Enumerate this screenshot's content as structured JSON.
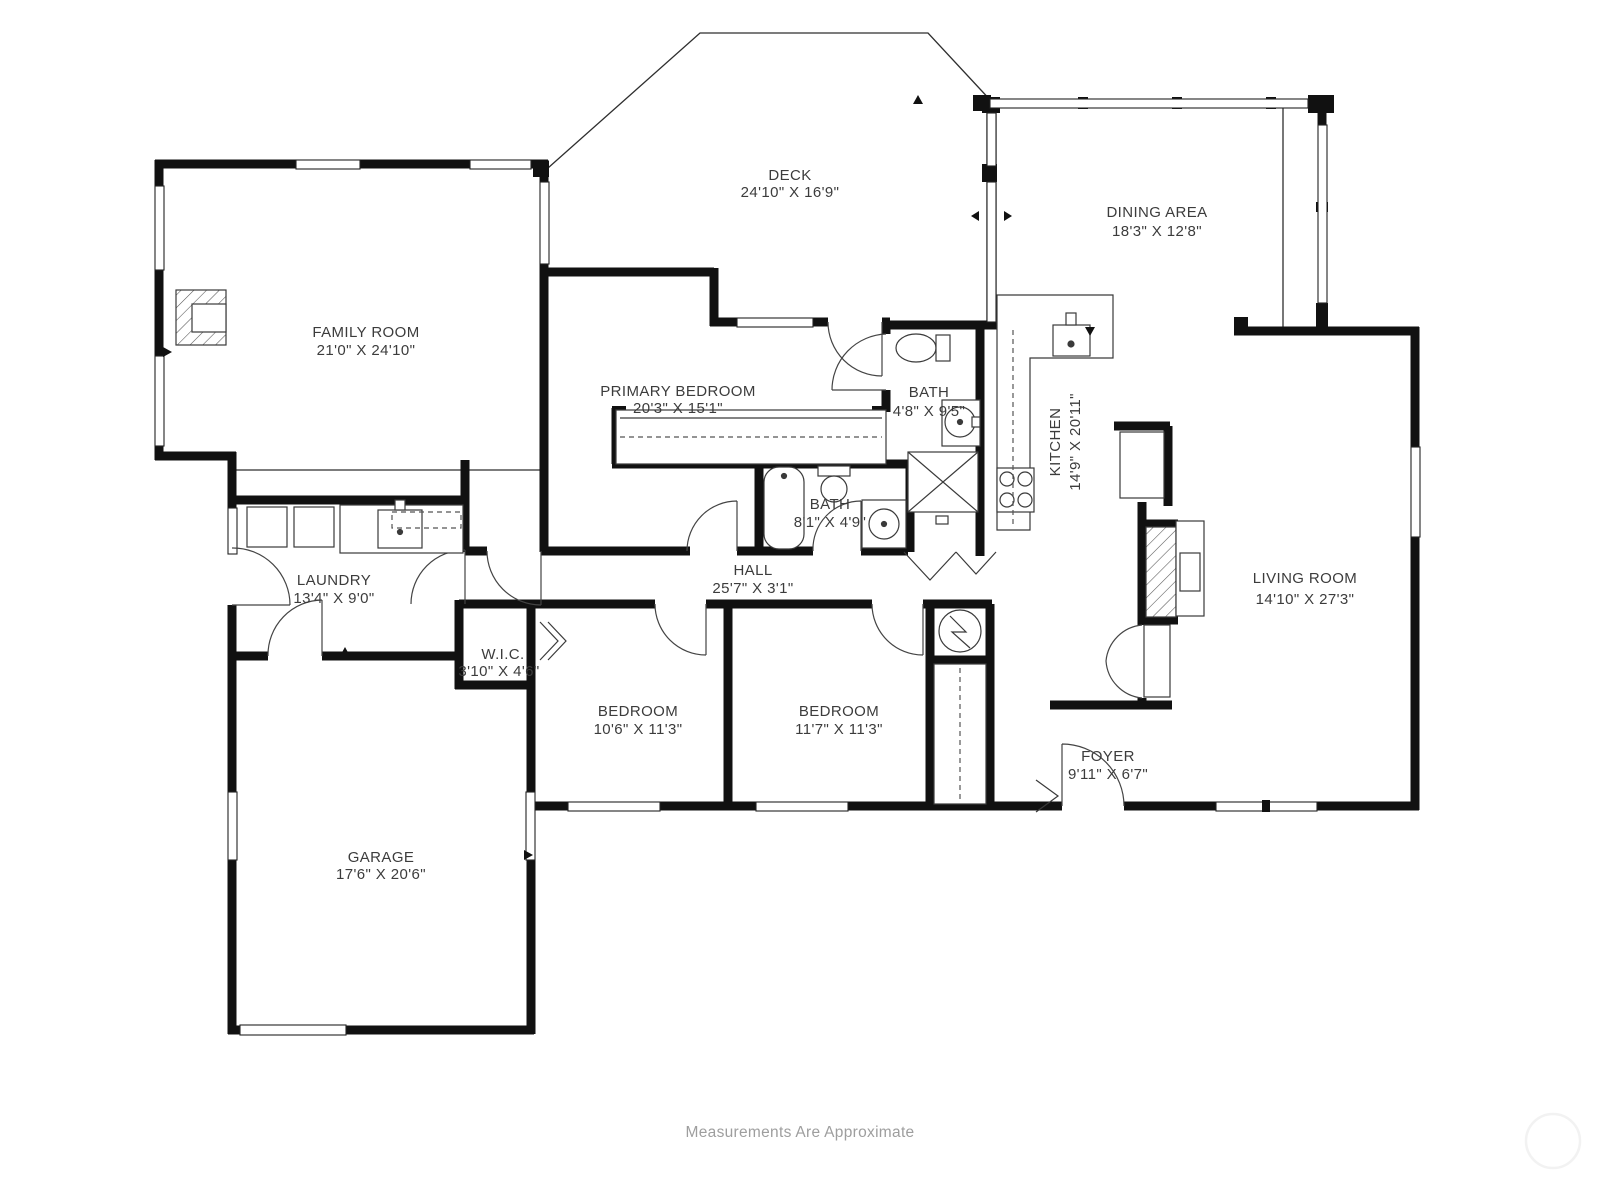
{
  "page": {
    "background": "#ffffff",
    "footer_note": "Measurements Are Approximate"
  },
  "rooms": [
    {
      "id": "deck",
      "name": "DECK",
      "dims": "24'10\" X 16'9\""
    },
    {
      "id": "dining",
      "name": "DINING AREA",
      "dims": "18'3\" X 12'8\""
    },
    {
      "id": "family",
      "name": "FAMILY ROOM",
      "dims": "21'0\" X 24'10\""
    },
    {
      "id": "primary",
      "name": "PRIMARY BEDROOM",
      "dims": "20'3\" X 15'1\""
    },
    {
      "id": "bath-upper",
      "name": "BATH",
      "dims": "4'8\" X 9'5\""
    },
    {
      "id": "kitchen",
      "name": "KITCHEN",
      "dims": "14'9\" X 20'11\""
    },
    {
      "id": "bath-hall",
      "name": "BATH",
      "dims": "8'1\" X 4'9\""
    },
    {
      "id": "hall",
      "name": "HALL",
      "dims": "25'7\" X 3'1\""
    },
    {
      "id": "laundry",
      "name": "LAUNDRY",
      "dims": "13'4\" X 9'0\""
    },
    {
      "id": "wic",
      "name": "W.I.C.",
      "dims": "3'10\" X 4'6\""
    },
    {
      "id": "bedroom-1",
      "name": "BEDROOM",
      "dims": "10'6\" X 11'3\""
    },
    {
      "id": "bedroom-2",
      "name": "BEDROOM",
      "dims": "11'7\" X 11'3\""
    },
    {
      "id": "living",
      "name": "LIVING ROOM",
      "dims": "14'10\" X 27'3\""
    },
    {
      "id": "foyer",
      "name": "FOYER",
      "dims": "9'11\" X 6'7\""
    },
    {
      "id": "garage",
      "name": "GARAGE",
      "dims": "17'6\" X 20'6\""
    }
  ],
  "wall_color": "#111111",
  "line_color": "#2e2e2e"
}
